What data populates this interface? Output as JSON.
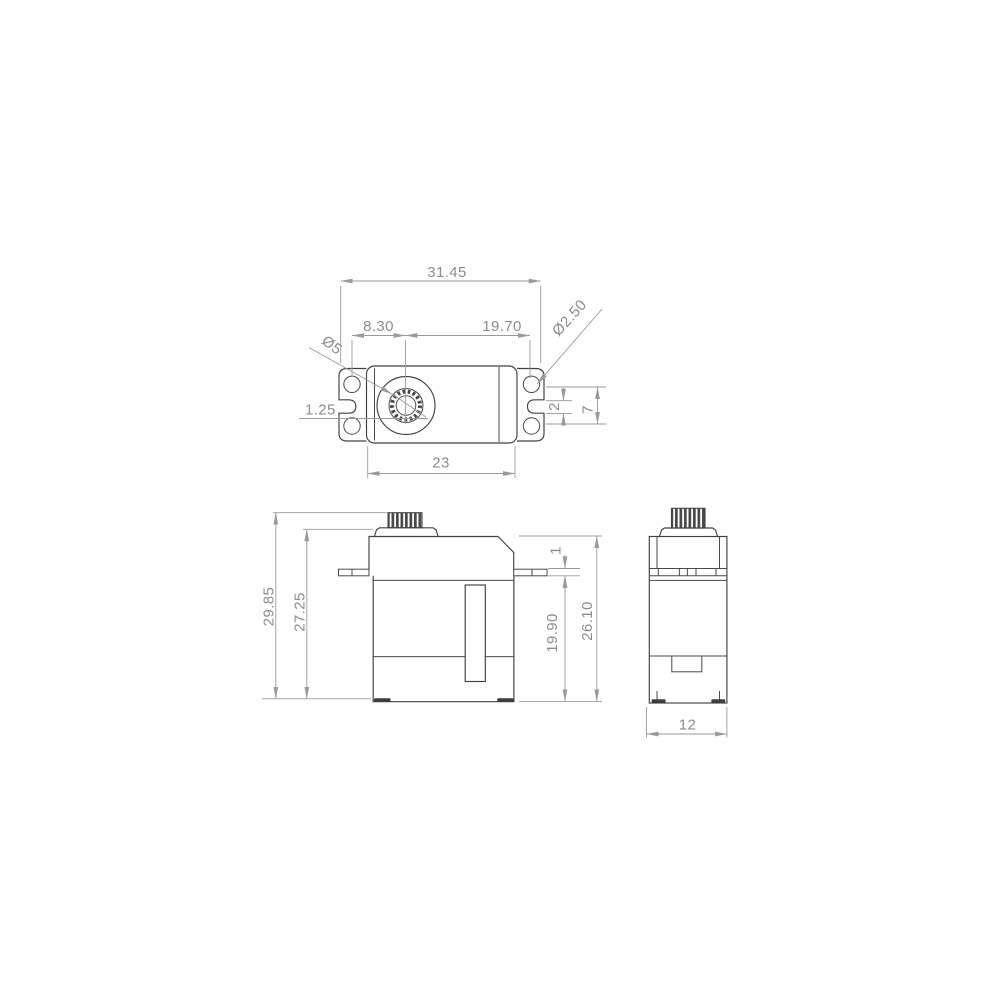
{
  "drawing": {
    "kind": "technical-dimension-drawing",
    "part": "micro-servo",
    "colors": {
      "background": "#ffffff",
      "outline": "#404040",
      "dimension_lines": "#9a9a9a",
      "dimension_text": "#8c8c8c",
      "knurl": "#4a4a4a"
    },
    "top_view": {
      "dim_overall_width": "31.45",
      "dim_hole_to_shaft": "8.30",
      "dim_shaft_to_hole": "19.70",
      "dim_mount_hole_dia": "Ø2.50",
      "dim_shaft_dia": "Ø5",
      "dim_offset": "1.25",
      "dim_body_width": "23",
      "dim_slot_width": "2",
      "dim_hole_spacing": "7"
    },
    "front_view": {
      "dim_total_height": "29.85",
      "dim_height_no_spline": "27.25",
      "dim_flange_thickness": "1",
      "dim_lower_height": "19.90",
      "dim_case_height": "26.10"
    },
    "side_view": {
      "dim_depth": "12"
    }
  }
}
